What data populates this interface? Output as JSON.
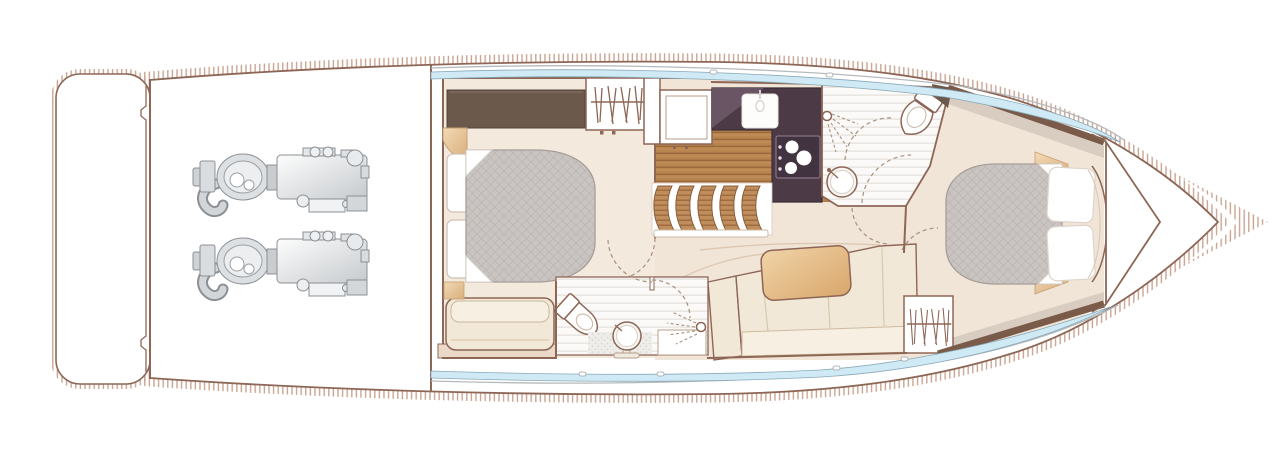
{
  "title": "Motor yacht lower deck floor plan",
  "colors": {
    "wall": "#8d6656",
    "hatch": "#c9a492",
    "floor": "#f1e5d8",
    "cabin_floor": "#f4e9dd",
    "bath_floor": "#fbfaf8",
    "wood": "#b9854f",
    "counter": "#4c3b46",
    "counter_highlight": "#6a5564",
    "hob": "#413440",
    "bed": "#c9c4c1",
    "wardrobe": "#6b594b",
    "window": "#cfe9f5",
    "sofa": "#f2e8d8",
    "sofa_back": "#f7f0e2",
    "table": "#e3b988",
    "tan": "#e9c69e",
    "cornice": "#d8cdc0",
    "engine": "#dde0e2"
  },
  "areas": {
    "swim_platform": "swim-platform",
    "engine_room": {
      "engines": [
        "port-engine",
        "starboard-engine"
      ],
      "detail": "twin-diesel-with-exhaust"
    },
    "mid_cabin": {
      "furniture": [
        "double-bed",
        "pillows",
        "wardrobe",
        "hanging-locker",
        "sofa",
        "corner-shelf"
      ]
    },
    "mid_bathroom": {
      "fixtures": [
        "toilet",
        "pedestal-basin",
        "shower-head"
      ]
    },
    "galley": {
      "fixtures": [
        "sink",
        "hob-3-burner",
        "fridge-units"
      ],
      "stairs": "companionway-steps"
    },
    "salon": {
      "furniture": [
        "corner-sofa",
        "table",
        "hanging-locker"
      ]
    },
    "day_head": {
      "fixtures": [
        "toilet",
        "round-basin",
        "shower-head"
      ]
    },
    "forward_cabin": {
      "furniture": [
        "island-double-bed",
        "pillows",
        "headboard",
        "side-lockers"
      ]
    },
    "bow": "anchor-locker",
    "windows": [
      "port-hull-window-strip",
      "starboard-hull-window-strip"
    ]
  }
}
